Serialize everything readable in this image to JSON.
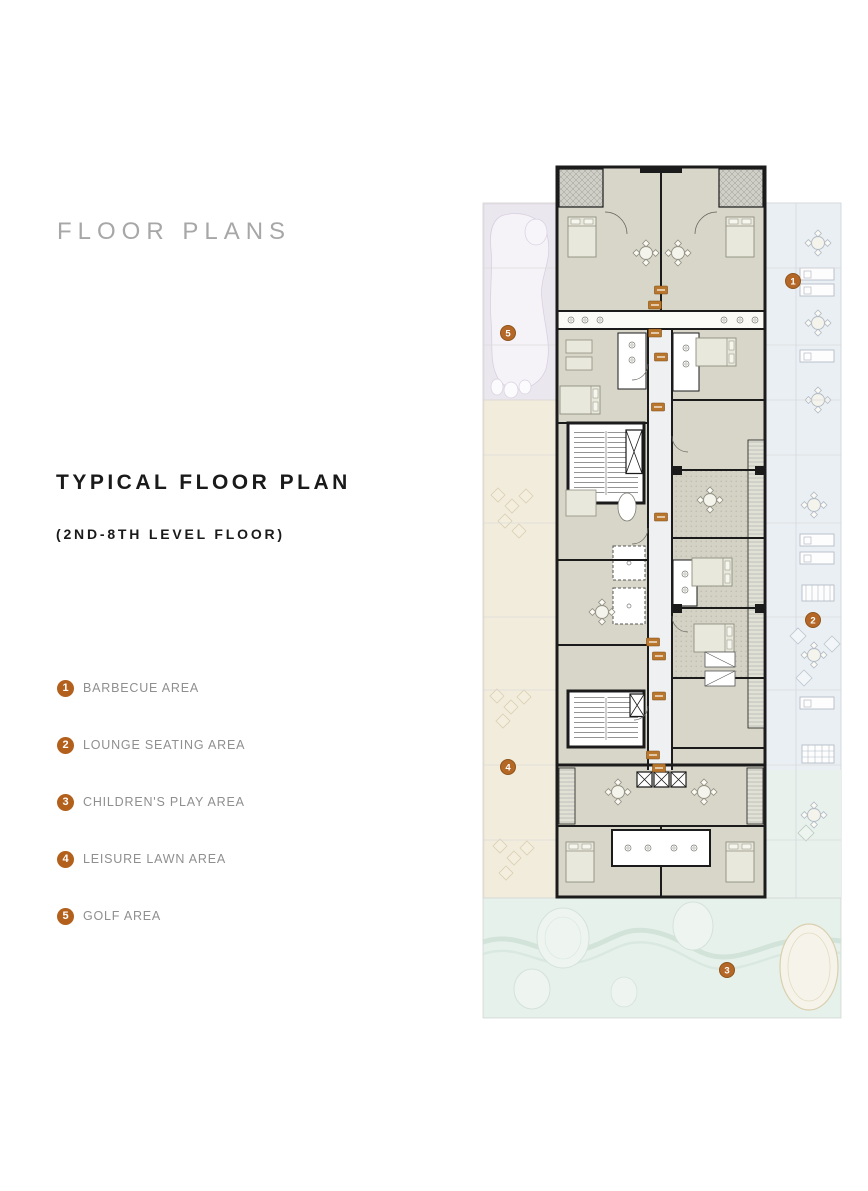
{
  "header": {
    "title": "FLOOR PLANS"
  },
  "section": {
    "title": "TYPICAL FLOOR PLAN",
    "subtitle": "(2ND-8TH LEVEL FLOOR)"
  },
  "legend": {
    "items": [
      {
        "number": "1",
        "label": "BARBECUE AREA"
      },
      {
        "number": "2",
        "label": "LOUNGE SEATING AREA"
      },
      {
        "number": "3",
        "label": "CHILDREN'S PLAY AREA"
      },
      {
        "number": "4",
        "label": "LEISURE LAWN AREA"
      },
      {
        "number": "5",
        "label": "GOLF AREA"
      }
    ]
  },
  "plan": {
    "markers": [
      {
        "number": "1",
        "area": "barbecue-area"
      },
      {
        "number": "2",
        "area": "lounge-seating-area"
      },
      {
        "number": "3",
        "area": "childrens-play-area"
      },
      {
        "number": "4",
        "area": "leisure-lawn-area"
      },
      {
        "number": "5",
        "area": "golf-area"
      }
    ],
    "colors": {
      "accent_orange": "#b2601c",
      "tag_orange": "#b9772e",
      "wall": "#1b1b1b",
      "room_fill": "#d7d6c8",
      "corridor_fill": "#eef0f2",
      "golf_zone": "#ebe7ef",
      "lawn_zone": "#f2ecdd",
      "barbecue_zone": "#eaeff4",
      "play_zone": "#e7f1eb"
    }
  }
}
